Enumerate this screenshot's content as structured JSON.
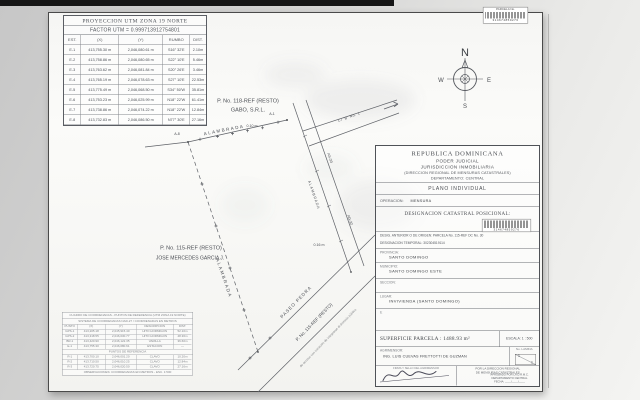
{
  "utm_table": {
    "title": "PROYECCION UTM ZONA 19 NORTE",
    "factor": "FACTOR UTM = 0.999713912754801",
    "headers": [
      "EST.",
      "(X)",
      "(Y)",
      "RUMBO",
      "DIST."
    ],
    "rows": [
      [
        "E-1",
        "413,755.30 m",
        "2,046,080.61 m",
        "S16° 32'E",
        "2.10m"
      ],
      [
        "E-2",
        "413,758.86 m",
        "2,046,080.65 m",
        "S22° 10'E",
        "5.46m"
      ],
      [
        "E-3",
        "413,763.62 m",
        "2,046,081.84 m",
        "S20° 26'E",
        "3.46m"
      ],
      [
        "E-4",
        "413,765.19 m",
        "2,046,078.63 m",
        "S27° 10'E",
        "22.53m"
      ],
      [
        "E-5",
        "413,775.49 m",
        "2,046,068.50 m",
        "S34° 50'W",
        "35.81m"
      ],
      [
        "E-6",
        "413,753.23 m",
        "2,046,025.99 m",
        "N18° 22'W",
        "61.41m"
      ],
      [
        "E-7",
        "413,738.86 m",
        "2,046,074.22 m",
        "N18° 22'W",
        "12.84m"
      ],
      [
        "E-8",
        "413,732.83 m",
        "2,046,086.50 m",
        "N77° 30'E",
        "27.16m"
      ]
    ]
  },
  "plan": {
    "parcel_top_label_line1": "P. No. 118-REF (RESTO)",
    "parcel_top_label_line2": "GABO, S.R.L.",
    "parcel_left_label_line1": "P. No. 115-REF (RESTO)",
    "parcel_left_label_line2": "JOSE MERCEDES GARCIA J.",
    "fence_top": "ALAMBRADA",
    "fence_left": "ALAMBRADA",
    "fence_road": "ALAMBRADA",
    "station_top_left": "A-8",
    "station_top_right": "A-1",
    "offset_top": "0.10 m",
    "offset_road": "0.16 m",
    "station_road_upper": "AS-30",
    "station_road_lower": "AG-32",
    "branch_road": "C/ 'B' No. 1",
    "paseo_name": "PASEO PEDRA",
    "paseo_parcel": "P. No. 115-REF (RESTO)",
    "paseo_note": "de acceso con vocación de integrarse al dominio público",
    "compass": {
      "n": "N",
      "w": "W",
      "e": "E",
      "s": "S"
    }
  },
  "title_block": {
    "country": "REPUBLICA DOMINICANA",
    "poder": "PODER JUDICIAL",
    "jurisdiccion": "JURISDICCION INMOBILIARIA",
    "direccion": "(DIRECCION REGIONAL DE MENSURAS CATASTRALES)",
    "departamento": "DEPARTAMENTO:   CENTRAL",
    "plano": "PLANO INDIVIDUAL",
    "operacion_label": "OPERACION:",
    "operacion_value": "MENSURA",
    "designacion_posicional": "DESIGNACION CATASTRAL POSICIONAL:",
    "origen": "DESIG. ANTERIOR O DE ORIGEN:   PARCELA No. 115-REF      DC No. 30",
    "temporal": "DESIGNACION TEMPORAL:   302304519114",
    "provincia_label": "PROVINCIA:",
    "provincia_value": "SANTO DOMINGO",
    "municipio_label": "MUNICIPIO:",
    "municipio_value": "SANTO DOMINGO ESTE",
    "seccion_label": "SECCION:",
    "lugar_label": "LUGAR:",
    "lugar_value": "INVIVIENDA (SANTO DOMINGO)",
    "stray_mark": "E",
    "superficie": "SUPERFICIE PARCELA : 1488.93 m²",
    "escala": "ESCALA:   1 : 500",
    "agrimensor_label": "AGRIMENSOR:",
    "agrimensor_value": "ING. LUIS CUEVAS FRETTOTTI DE GUZMAN",
    "lamina_label": "No. LAMINA",
    "lamina_a": "1",
    "lamina_b": "1",
    "firma_caption": "FIRMA Y SELLO DEL AGRIMENSOR",
    "aprobacion_line1": "POR LA DIRECCION REGIONAL",
    "aprobacion_line2": "DE MENSURAS CATASTRALES",
    "stamp_line1": "APROBADO POR LA D.R.M.C.",
    "stamp_line2": "DEPARTAMENTO CENTRAL",
    "stamp_line3": "FECHA: ____/____/____"
  },
  "stickers": {
    "top": {
      "line1": "PARCELA No.",
      "number": "314674859276"
    },
    "designacion": {
      "number": "314674859276"
    }
  },
  "ref_table": {
    "title": "CUADRO DE COORDENADAS - PUNTOS DE REFERENCIA (UTM ZONA 19 NORTE)",
    "subtitle": "SISTEMA DE COORDENADAS NAD-27  /  COORDENADAS EN METROS",
    "headers": [
      "PUNTO",
      "(X)",
      "(Y)",
      "DESCRIPCION",
      "DIST."
    ],
    "rows": [
      [
        "GPS-1",
        "413,205.18",
        "2,045,915.40",
        "HITO HORMIGON",
        "52.10m"
      ],
      [
        "GPS-2",
        "413,318.55",
        "2,046,030.77",
        "HITO HORMIGON",
        "48.36m"
      ],
      [
        "BR-1",
        "413,420.90",
        "2,046,122.35",
        "VARILLA",
        "36.60m"
      ],
      [
        "E-1",
        "413,755.30",
        "2,046,080.61",
        "ESTACION",
        "—"
      ]
    ],
    "section": "PUNTOS DE REFERENCIA",
    "rows2": [
      [
        "R-1",
        "413,700.10",
        "2,046,001.20",
        "CLAVO",
        "10.20m"
      ],
      [
        "R-2",
        "413,710.50",
        "2,046,010.25",
        "CLAVO",
        "12.84m"
      ],
      [
        "R-3",
        "413,720.75",
        "2,046,020.50",
        "CLAVO",
        "27.16m"
      ]
    ],
    "footer": "OBSERVACIONES: COORDENADAS EN METROS  -  ESC. 1:500"
  }
}
